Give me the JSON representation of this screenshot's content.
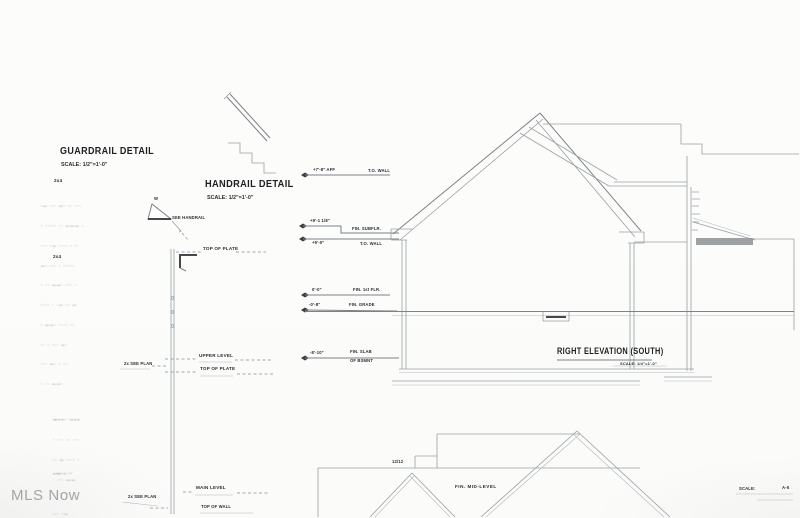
{
  "watermark": "MLS Now",
  "guardrail_detail": {
    "title": "GUARDRAIL DETAIL",
    "scale": "SCALE: 1/2\"=1'-0\""
  },
  "handrail_detail": {
    "title": "HANDRAIL DETAIL",
    "scale": "SCALE: 1/2\"=1'-0\""
  },
  "right_elevation": {
    "title": "RIGHT ELEVATION (SOUTH)",
    "scale": "SCALE: 1/4\"=1'-0\""
  },
  "section_labels": {
    "top_of_plate_upper": "TOP OF PLATE",
    "upper_level": "UPPER LEVEL",
    "top_of_plate_lower": "TOP OF PLATE",
    "main_level": "MAIN LEVEL",
    "top_of_wall": "TOP OF WALL",
    "see_plan_upper": "2x SEE PLAN",
    "see_plan_lower": "2x SEE PLAN",
    "stud_upper": "2x4",
    "stud_lower": "2x4",
    "rail_size": "W",
    "see_handrail": "SEE HANDRAIL"
  },
  "datum_markers": [
    {
      "elevation": "+7'-8\" AFF",
      "label": "T.O. WALL"
    },
    {
      "elevation": "+9'-1 1/8\"",
      "label": "FIN. SUBFLR."
    },
    {
      "elevation": "+9'-0\"",
      "label": "T.O. WALL"
    },
    {
      "elevation": "0'-0\"",
      "label": "FIN. 1st FLR."
    },
    {
      "elevation": "-0'-8\"",
      "label": "FIN. GRADE"
    },
    {
      "elevation": "-8'-10\"",
      "label": "FIN. SLAB",
      "label2": "OF BSMNT"
    }
  ],
  "lower_drawing": {
    "pitch": "12/12",
    "label": "FIN. MID-LEVEL"
  },
  "sheet_footer": {
    "scale_label": "SCALE:",
    "sheet": "A-5"
  },
  "note_blocks": {
    "guardrail_specs": [
      "·— ··· ―· ·· ···",
      "· ····· ·· ——— ·",
      "··· ·— ···· · ··",
      "—· ··· · ·····",
      "· ·· ——· ··· ·",
      "···· · ·— ·· —",
      "· ——· ···· ··",
      "·· · ··· —·",
      "··· —· · ··",
      "· ·· ——·"
    ],
    "mid_note": [
      "—––· ·–––",
      "· ··· ·· ···",
      "·· — ···· ·",
      "· ··· ——"
    ],
    "low_note": [
      "–—·– ··",
      "· ·· ···",
      "··· ·—"
    ]
  },
  "colors": {
    "line": "#9aa0a4",
    "dark_line": "#44484c",
    "text": "#2a2d30",
    "shade": "#8d9094",
    "watermark": "#a2a6a8"
  }
}
